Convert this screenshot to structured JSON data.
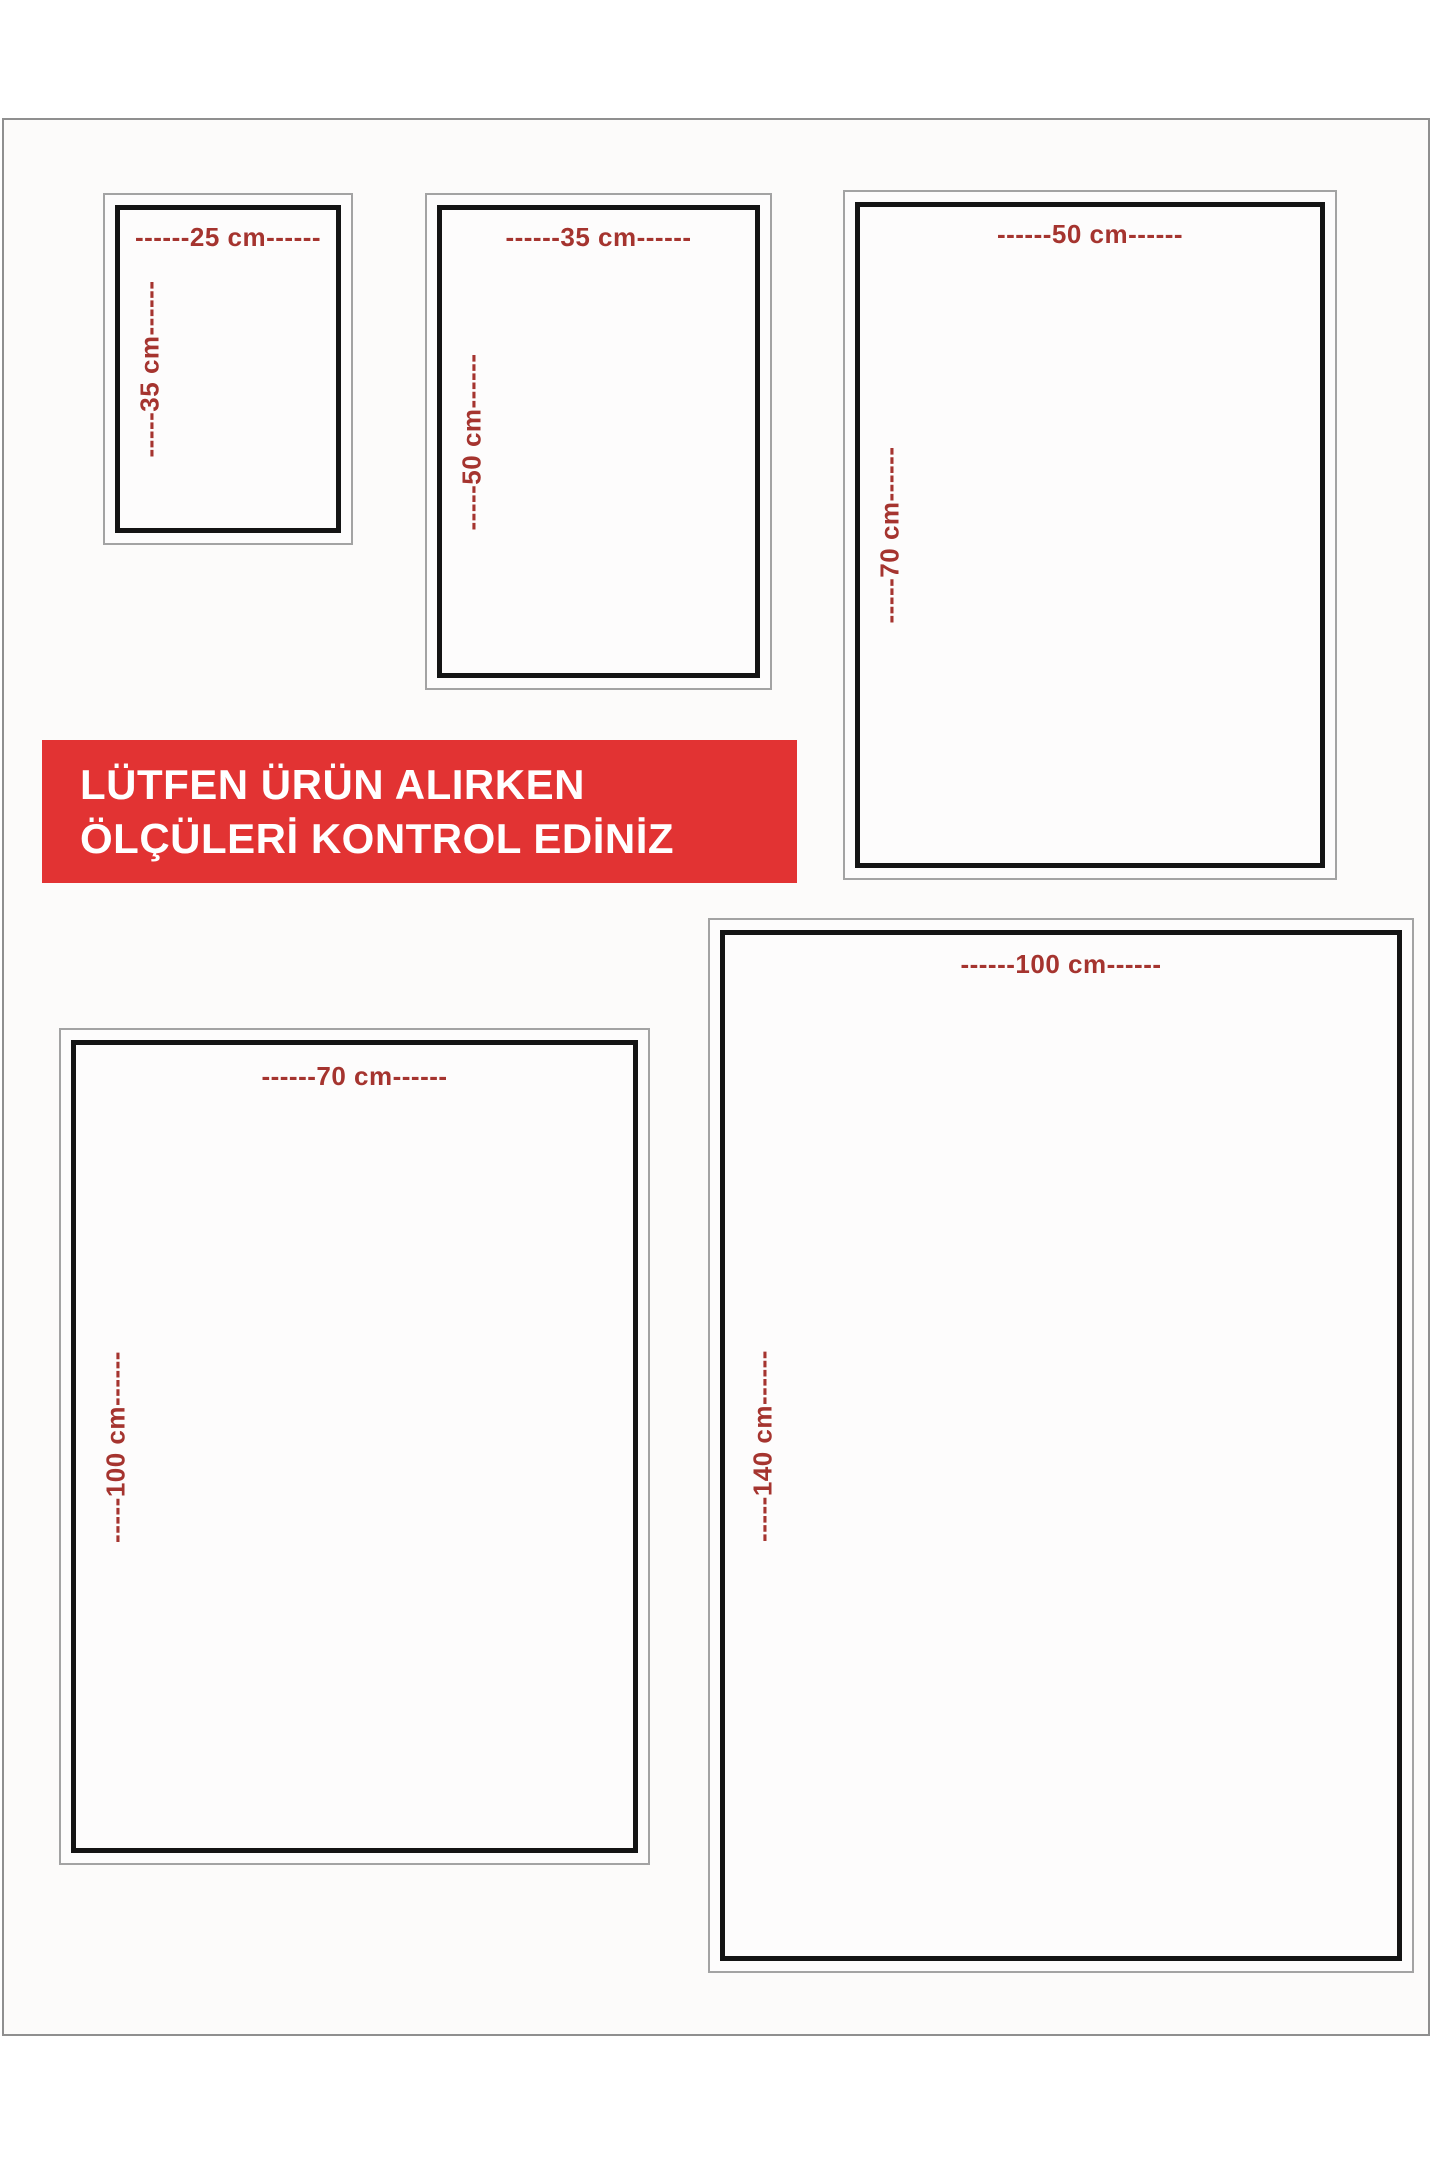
{
  "banner": {
    "line1": "LÜTFEN ÜRÜN ALIRKEN",
    "line2": "ÖLÇÜLERİ KONTROL EDİNİZ",
    "bg_color": "#e23333",
    "text_color": "#ffffff"
  },
  "colors": {
    "dimension_text": "#a5342f",
    "inner_border": "#141414",
    "outer_border": "#a3a3a3",
    "page_frame": "#8f8f8f",
    "background": "#ffffff"
  },
  "sizes": [
    {
      "name": "25x35",
      "width_cm": 25,
      "height_cm": 35,
      "width_label": "------25 cm------",
      "height_label": "-----35 cm------"
    },
    {
      "name": "35x50",
      "width_cm": 35,
      "height_cm": 50,
      "width_label": "------35 cm------",
      "height_label": "-----50 cm------"
    },
    {
      "name": "50x70",
      "width_cm": 50,
      "height_cm": 70,
      "width_label": "------50 cm------",
      "height_label": "-----70 cm------"
    },
    {
      "name": "70x100",
      "width_cm": 70,
      "height_cm": 100,
      "width_label": "------70 cm------",
      "height_label": "-----100 cm------"
    },
    {
      "name": "100x140",
      "width_cm": 100,
      "height_cm": 140,
      "width_label": "------100 cm------",
      "height_label": "-----140 cm------"
    }
  ]
}
